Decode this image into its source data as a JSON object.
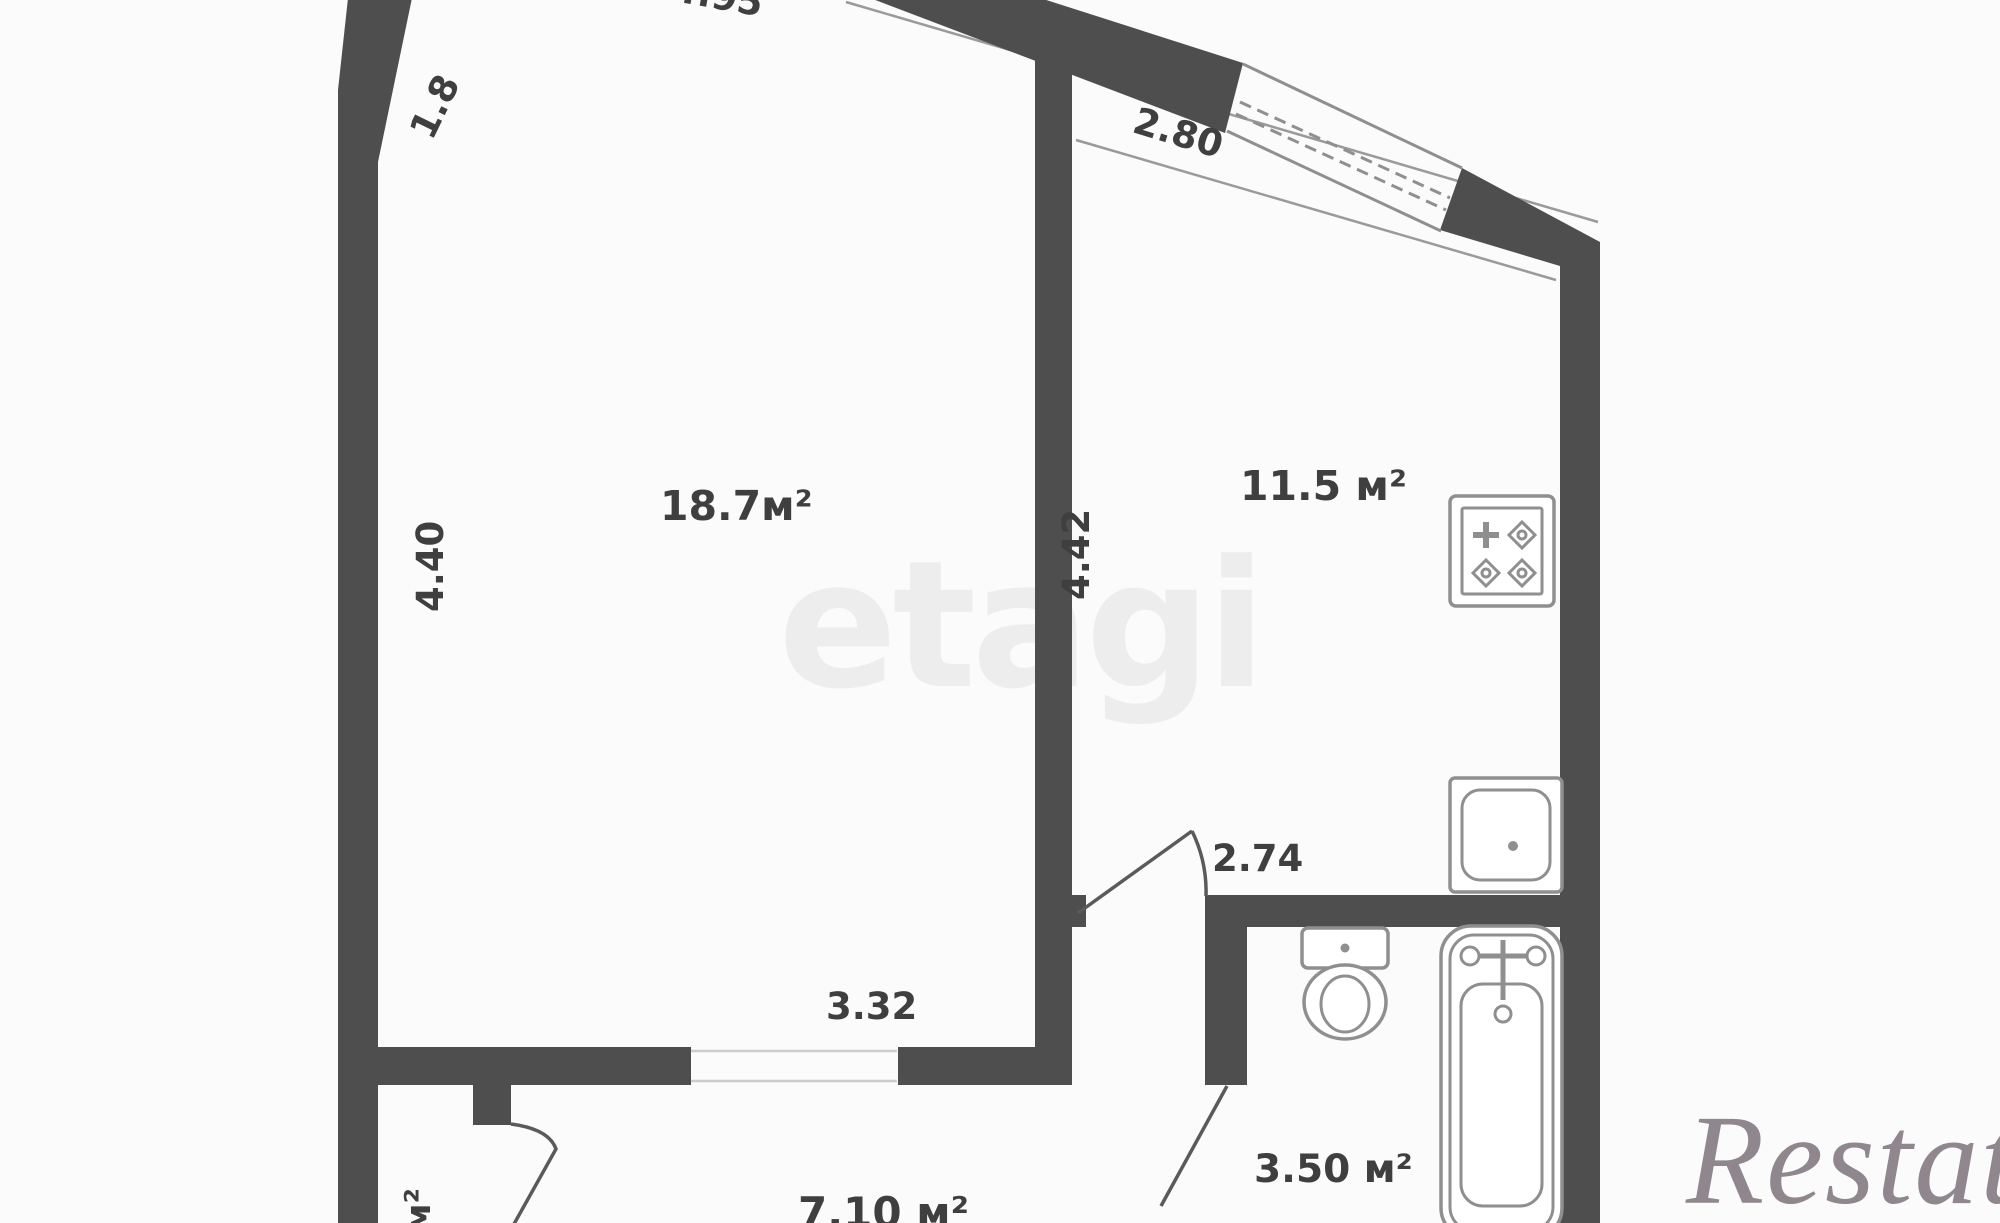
{
  "title": "apartment-floor-plan",
  "watermarks": {
    "center": "etagi",
    "brand": "Restate"
  },
  "rooms": {
    "living": {
      "area": "18.7м²"
    },
    "kitchen": {
      "area": "11.5 м²"
    },
    "bathroom": {
      "area": "3.50 м²"
    },
    "hallway": {
      "area": "7.10 м²"
    },
    "closet": {
      "area_partial": "м²"
    }
  },
  "dims": {
    "left_wall": "4.40",
    "kitchen_wall": "4.42",
    "living_opening": "3.32",
    "kitchen_doorway": "2.74",
    "window": "2.80",
    "upper_left_wall": "1.8",
    "top_wall_partial": "4.95"
  },
  "fixtures": [
    "stove-icon",
    "kitchen-sink-icon",
    "toilet-icon",
    "bathtub-icon"
  ],
  "colors": {
    "wall": "#4e4e4e",
    "door_line": "#5a5a5a",
    "fixture_line": "#8f8f8f",
    "text": "#3f3f3f",
    "watermark_center": "#ededed",
    "watermark_brand": "#756b72",
    "background": "#fbfbfb"
  }
}
